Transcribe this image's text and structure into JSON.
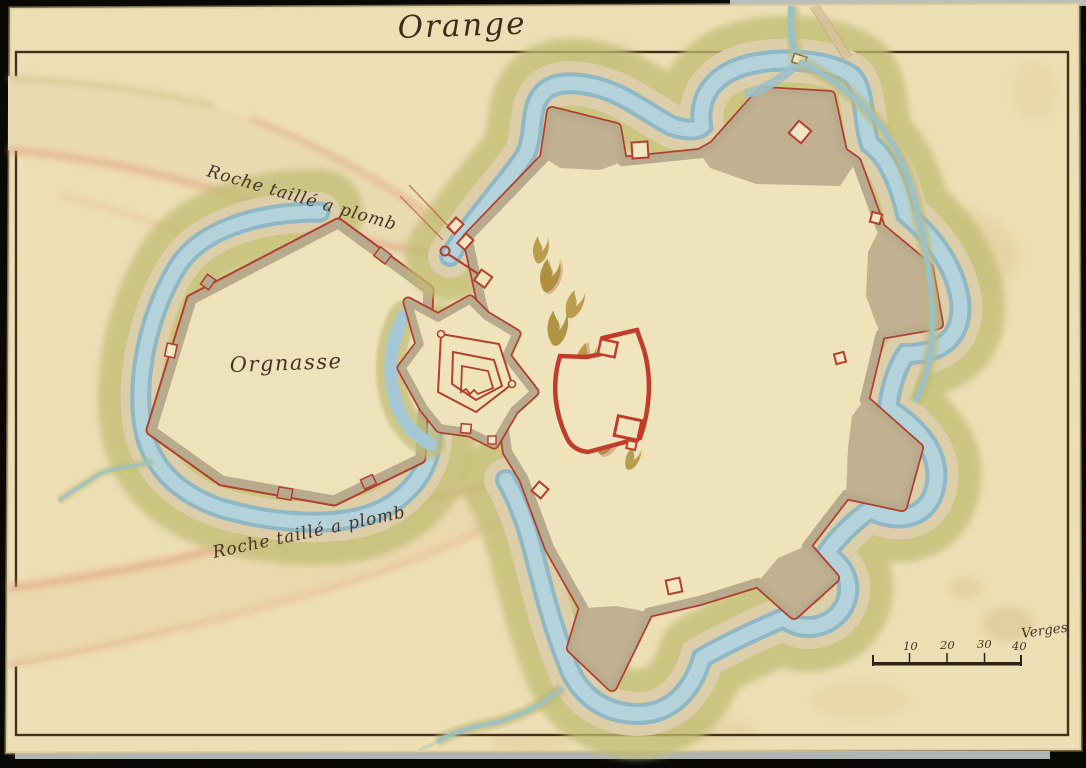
{
  "map": {
    "title": "Orange",
    "labels": {
      "rock_north": "Roche taillé a plomb",
      "district": "Orgnasse",
      "rock_south": "Roche taillé a plomb",
      "scale_unit": "Verges"
    },
    "scale_bar": {
      "ticks": [
        "10",
        "20",
        "30",
        "40"
      ]
    },
    "colors": {
      "paper": "#ecdfb5",
      "ink": "#473323",
      "frame_line": "#453019",
      "wall_red": "#b23f2e",
      "rampart_tan": "#b8aa8c",
      "moat_blue": "#a3c6d2",
      "glacis_green": "#c1bd72",
      "counterscarp": "#dbcea9",
      "ridge_beige": "#e9dab2",
      "cliff_pink": "#e09a78",
      "tree_olive": "#a98b36",
      "building_red": "#c23b2b"
    }
  }
}
